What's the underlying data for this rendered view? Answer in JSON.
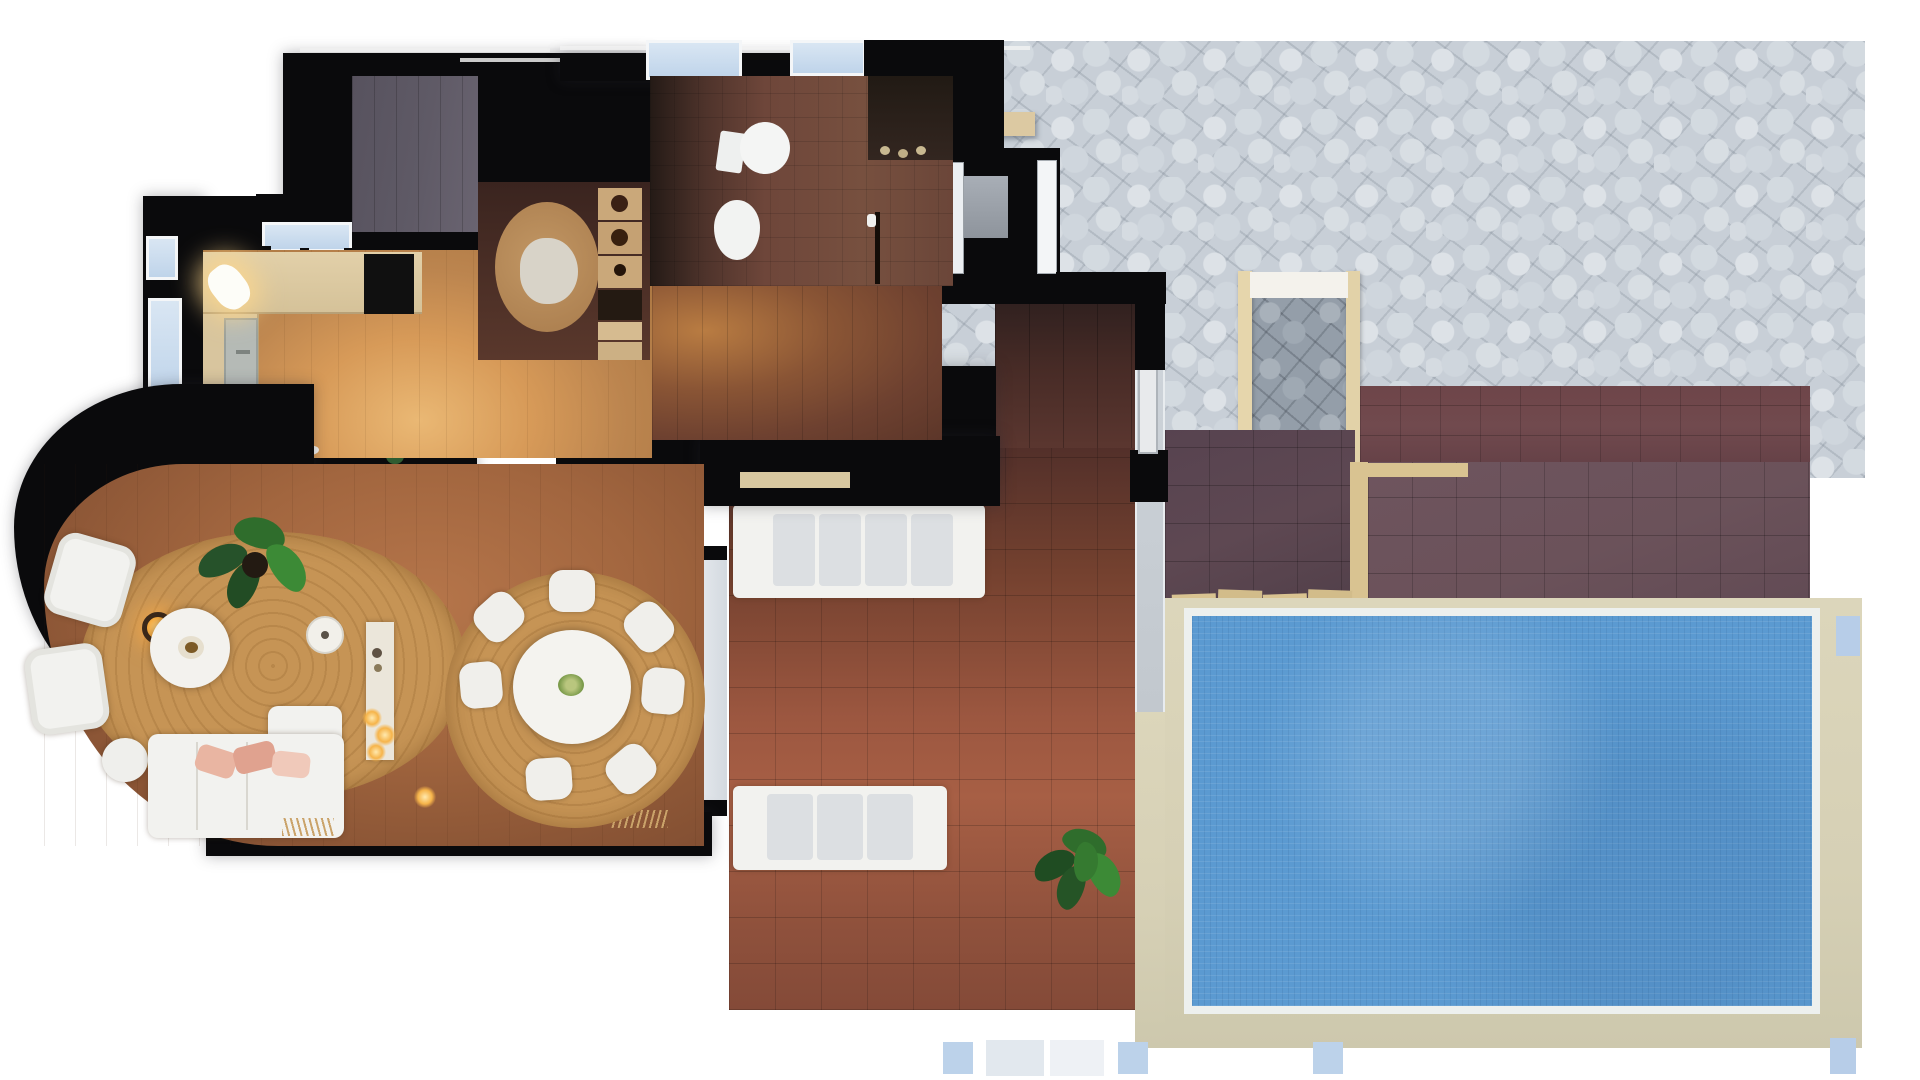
{
  "scene": {
    "type": "architectural-floorplan-render",
    "view": "top-down",
    "background_color": "#ffffff"
  },
  "palette": {
    "wall": "#0a0a0c",
    "stone_patio": "#c8cfd7",
    "terracotta_veranda": "#9c5740",
    "plum_steps_tile": "#5e4852",
    "brick_terrace": "#6e4549",
    "pool_water": "#5b9ad1",
    "pool_deck": "#d6d0b5",
    "warm_wood": "#d79a58",
    "mid_wood": "#a2663f",
    "dark_wood": "#6e4636",
    "jute_rug": "#c69455",
    "counter_wood": "#dcc9a2",
    "window_glass": "#cfe0f1",
    "white_furniture": "#f2f2ef",
    "blush_pillow": "#e9b5a2",
    "plant_green": "#2f6d2c",
    "step_edging": "#d9c391",
    "gate_frame": "#e6d6ac"
  },
  "regions": [
    {
      "name": "stone-patio",
      "material": "flagstone"
    },
    {
      "name": "garden-gate",
      "material": "timber-frame"
    },
    {
      "name": "brick-terrace-band",
      "material": "brick-tile"
    },
    {
      "name": "steps-upper",
      "material": "plum-tile-with-timber-edging"
    },
    {
      "name": "steps-lower",
      "material": "plum-tile-with-timber-edging"
    },
    {
      "name": "pool-deck",
      "material": "cream-stone"
    },
    {
      "name": "swimming-pool",
      "material": "blue-mosaic"
    },
    {
      "name": "veranda",
      "material": "terracotta-tile"
    },
    {
      "name": "walkway",
      "material": "concrete"
    },
    {
      "name": "kitchen",
      "material": "warm-wood"
    },
    {
      "name": "bathroom",
      "material": "dark-tile"
    },
    {
      "name": "hallway",
      "material": "dark-wood"
    },
    {
      "name": "living-room",
      "material": "mid-wood"
    },
    {
      "name": "dining-area",
      "material": "mid-wood"
    },
    {
      "name": "entry-vestibule",
      "material": "shadowed"
    },
    {
      "name": "storage-room",
      "material": "dark"
    }
  ],
  "furniture": [
    "kitchen-counter",
    "cooktop",
    "kitchen-sink",
    "counter-lamp",
    "toilet",
    "bidet",
    "bathroom-vanity",
    "bathroom-door",
    "rattan-chair",
    "shelf-unit",
    "jute-rug",
    "armchair",
    "armchair",
    "ottoman",
    "coffee-table",
    "lantern-candle",
    "l-shaped-sofa",
    "blush-pillows",
    "pendant-lamp",
    "console-table",
    "potted-plant",
    "dining-rug",
    "dining-table",
    "dining-chairs-x7",
    "floor-candles",
    "outdoor-sofa-top",
    "outdoor-sofa-bottom",
    "veranda-plant",
    "patio-bench",
    "white-door",
    "fence-posts"
  ],
  "pool": {
    "shape": "rectangle",
    "water_color": "#5b9ad1",
    "coping_color": "#d6d0b5"
  }
}
